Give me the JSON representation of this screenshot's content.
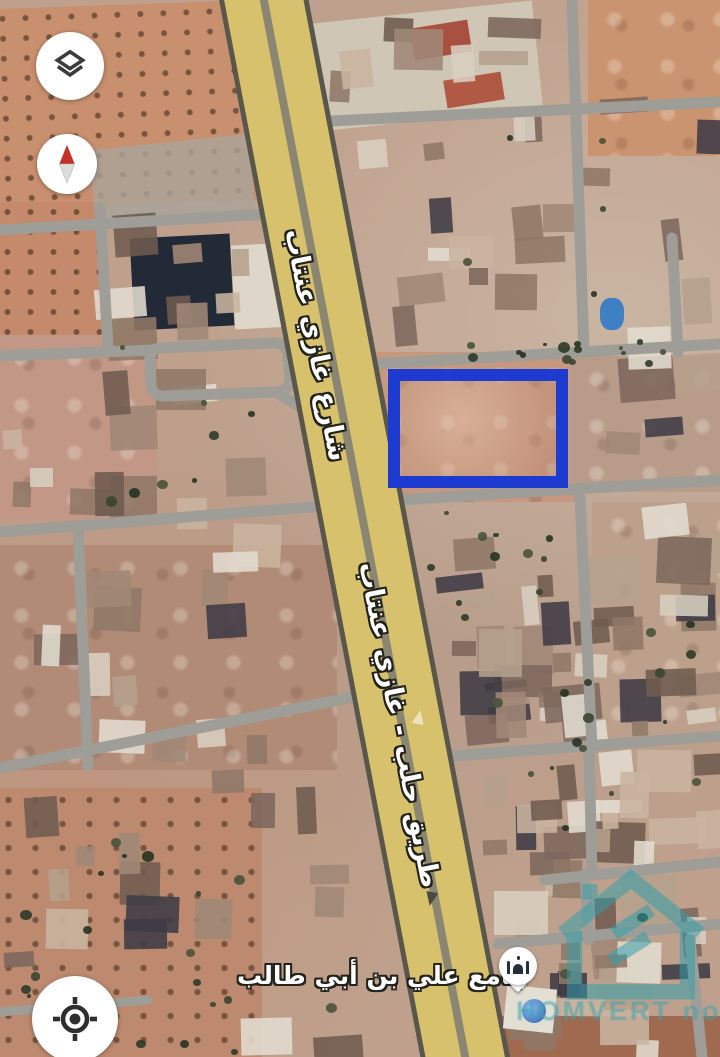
{
  "map_overlay": {
    "road_labels": [
      {
        "text": "شارع غازي عنتاب"
      },
      {
        "text": "طريق حلب - غازي عنتاب"
      }
    ],
    "mosque_label": "جامع علي بن أبي طالب",
    "plot_outline_color": "#1d3ad1",
    "highway_fill_color": "#d8c16c",
    "street_color": "#9e9d97",
    "marker_icon": "mosque-icon"
  },
  "controls": {
    "layers_icon": "layers-icon",
    "compass_icon": "compass-icon",
    "my_location_icon": "my-location-icon"
  },
  "watermark": {
    "text": "HOMVERT noga",
    "color": "#38a4b1"
  }
}
